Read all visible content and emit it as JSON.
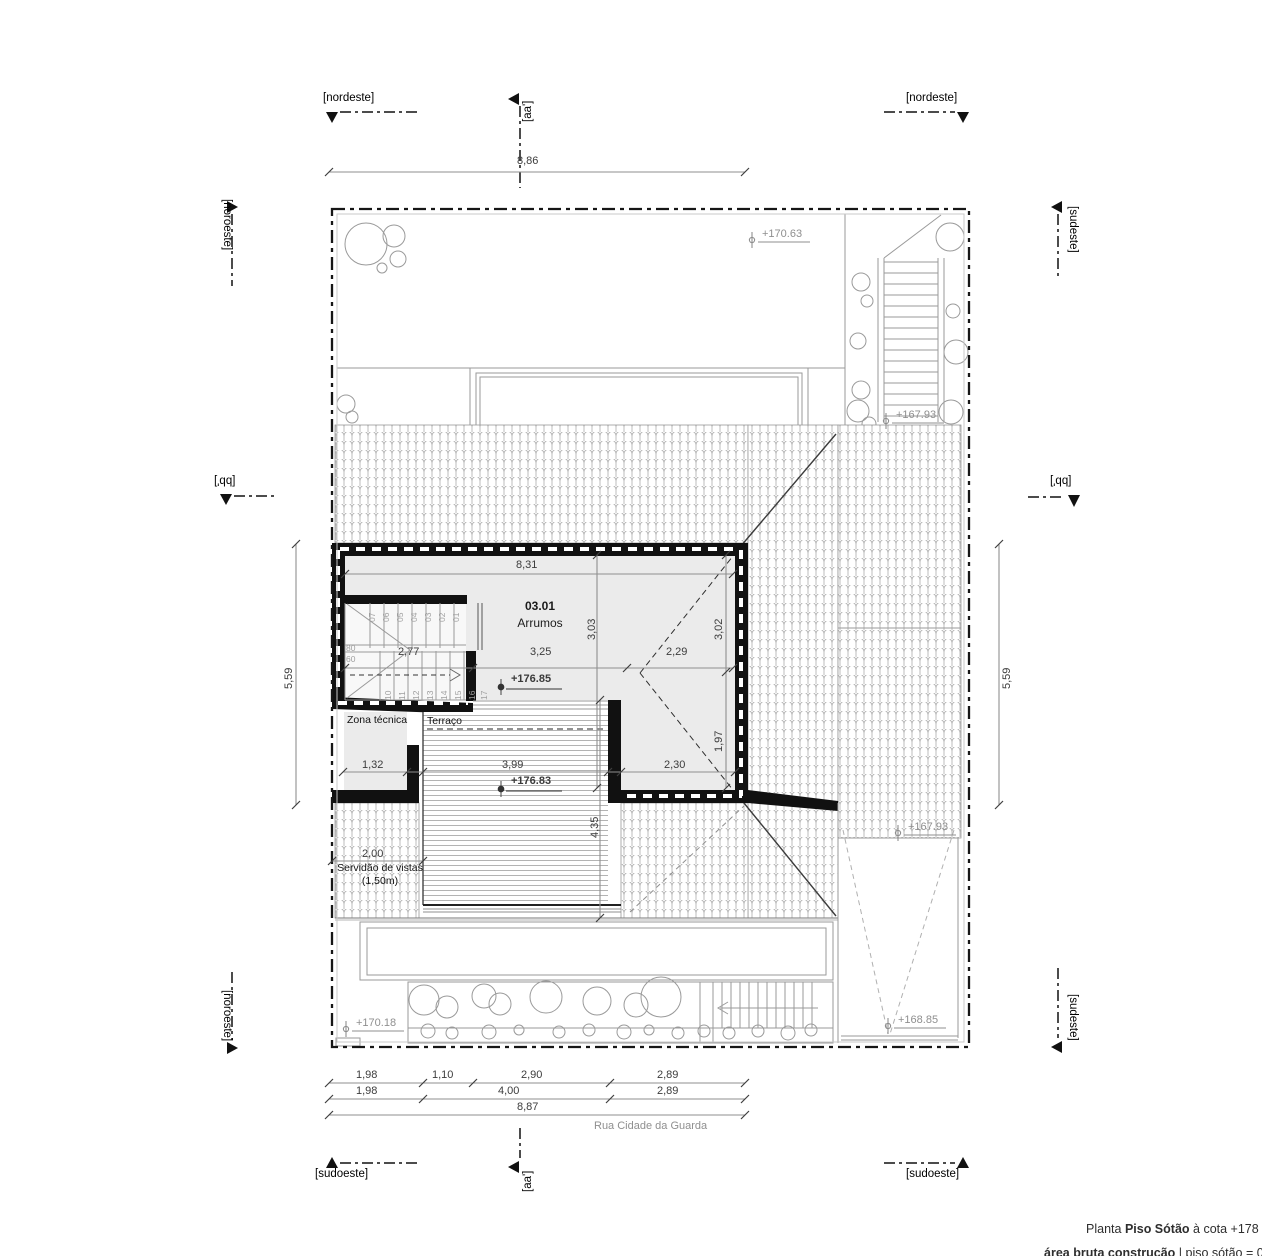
{
  "markers": {
    "nordeste": "[nordeste]",
    "noroeste": "[noroeste]",
    "sudeste": "[sudeste]",
    "sudoeste": "[sudoeste]",
    "aa": "[aa']",
    "bb": "[bb']"
  },
  "street": "Rua Cidade da Guarda",
  "title": {
    "prefix": "Planta",
    "name": "Piso Sótão",
    "suffix": "à cota +178",
    "area_label": "área bruta construção",
    "area_value": "| piso sótão = 03"
  },
  "rooms": {
    "code": "03.01",
    "name": "Arrumos",
    "zona": "Zona técnica",
    "terraco": "Terraço",
    "servidao_line1": "Servidão de vistas",
    "servidao_line2": "(1,50m)"
  },
  "levels": {
    "garden_top": "+170.63",
    "stair_top": "+167.93",
    "attic": "+176.85",
    "terrace": "+176.83",
    "court": "+167.93",
    "ramp": "+168.85",
    "garden_bottom": "+170.18"
  },
  "dims": {
    "top": "8,86",
    "left": "5,59",
    "right": "5,59",
    "room_w": "8,31",
    "chain_mid": [
      "2,77",
      "3,25",
      "2,29"
    ],
    "room_h": "3,03",
    "right_upper": "3,02",
    "right_lower": "1,97",
    "chain_low": [
      "1,32",
      "3,99",
      "2,30"
    ],
    "terrace_h": "4,35",
    "servidao": "2,00",
    "b1": [
      "1,98",
      "1,10",
      "2,90",
      "2,89"
    ],
    "b2": [
      "1,98",
      "4,00",
      "2,89"
    ],
    "total": "8,87"
  },
  "stairs": {
    "up": [
      "01",
      "02",
      "03",
      "04",
      "05",
      "06",
      "07"
    ],
    "down": [
      "10",
      "11",
      "12",
      "13",
      "14",
      "15",
      "16",
      "17"
    ],
    "w1": "80",
    "w2": "60"
  }
}
